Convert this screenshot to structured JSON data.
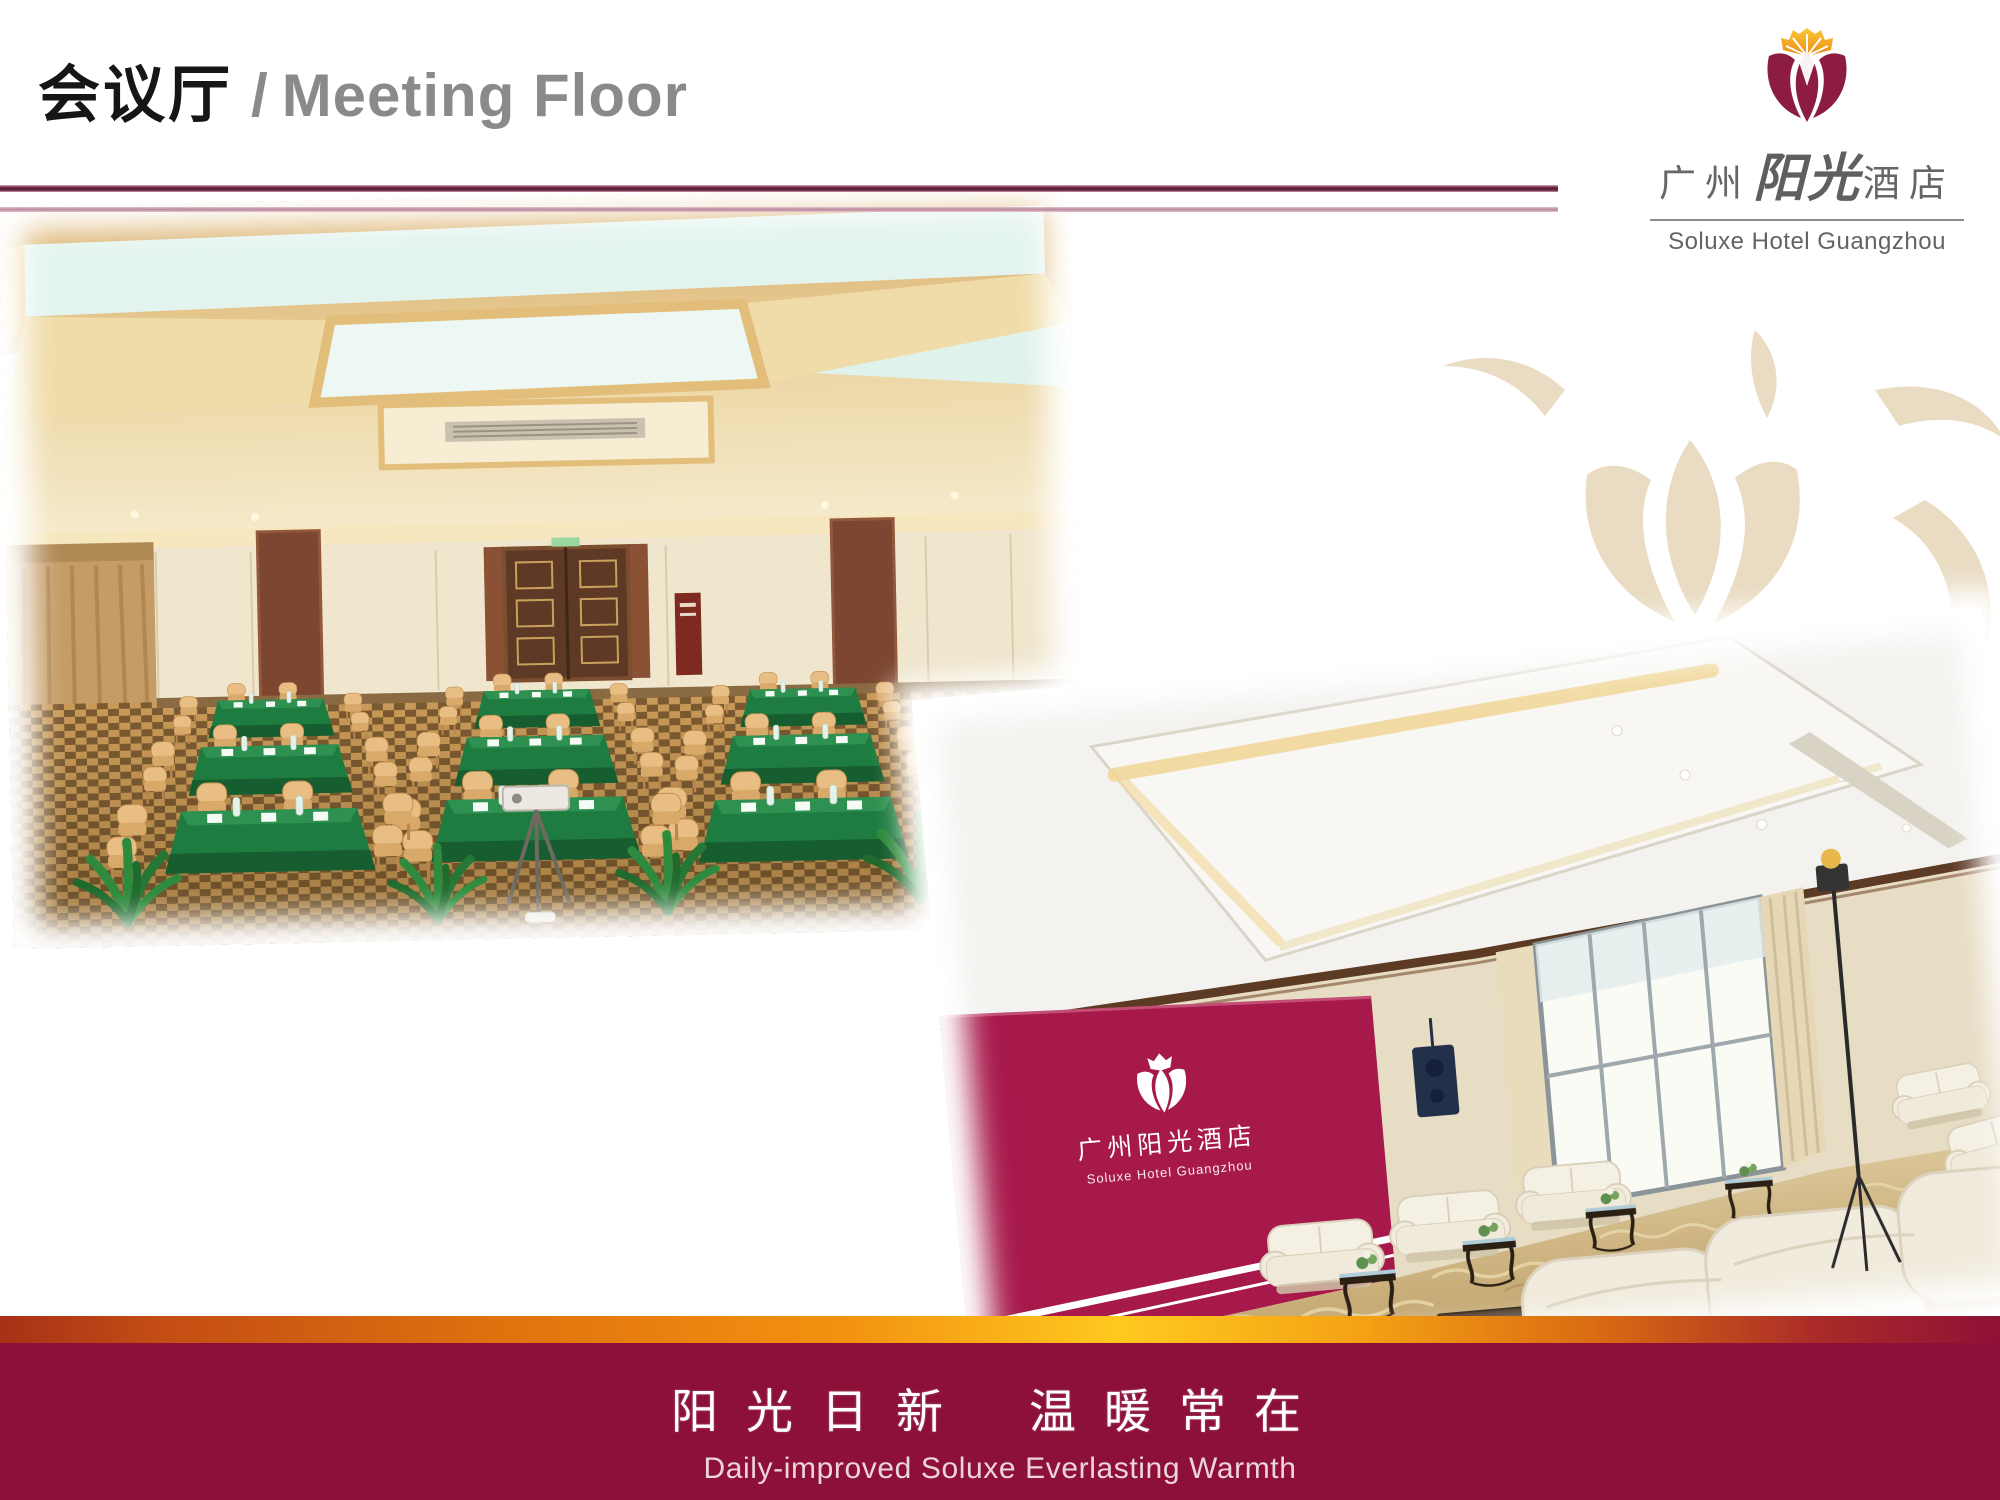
{
  "header": {
    "title_zh": "会议厅",
    "title_separator": "/",
    "title_en": "Meeting Floor"
  },
  "logo": {
    "zh_prefix": "广州",
    "zh_brand": "阳光",
    "zh_suffix": "酒店",
    "en": "Soluxe Hotel Guangzhou"
  },
  "photos": {
    "photo2_backdrop": {
      "zh": "广州阳光酒店",
      "en": "Soluxe Hotel Guangzhou"
    }
  },
  "footer": {
    "slogan_zh_left": "阳光日新",
    "slogan_zh_right": "温暖常在",
    "slogan_en": "Daily-improved Soluxe Everlasting Warmth"
  },
  "colors": {
    "footer_maroon": "#8C1037",
    "gold_band_center": "#FFC91F",
    "gold_band_edge": "#A63117",
    "divider_dark": "#6B2240",
    "divider_light": "#B9879A",
    "title_gray": "#8A8A8A",
    "logo_petal_maroon": "#8C1D40",
    "logo_fan_orange": "#F6A21C",
    "watermark_beige": "#EADCC3",
    "backdrop_crimson": "#A7184B",
    "tablecloth_green": "#1E7C40",
    "carpet_tan": "#C99A58"
  }
}
